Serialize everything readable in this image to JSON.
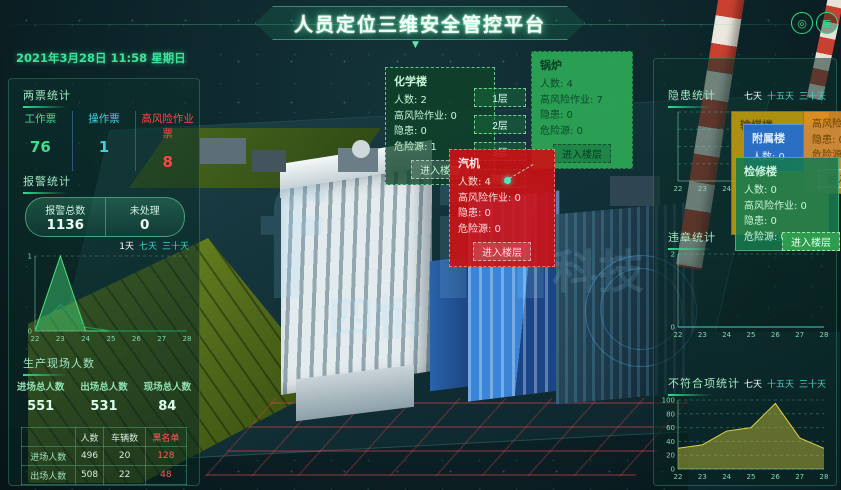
{
  "header": {
    "title": "人员定位三维安全管控平台",
    "datetime": "2021年3月28日 11:58 星期日",
    "icons": {
      "badge": "◎",
      "exit": "≣"
    },
    "caret": "▼"
  },
  "left": {
    "tickets": {
      "title": "两票统计",
      "items": [
        {
          "label": "工作票",
          "value": "76",
          "color": "#3fe08f"
        },
        {
          "label": "操作票",
          "value": "1",
          "color": "#3fd2e0"
        },
        {
          "label": "高风险作业票",
          "value": "8",
          "color": "#ff4545"
        }
      ]
    },
    "alarms": {
      "title": "报警统计",
      "total_label": "报警总数",
      "total_value": "1136",
      "pending_label": "未处理",
      "pending_value": "0",
      "legend": {
        "tabs": [
          "1天",
          "七天",
          "三十天"
        ],
        "active_tab": 0
      }
    },
    "site": {
      "title": "生产现场人数",
      "stats": [
        {
          "label": "进场总人数",
          "value": "551"
        },
        {
          "label": "出场总人数",
          "value": "531"
        },
        {
          "label": "现场总人数",
          "value": "84"
        }
      ],
      "table": {
        "headers": [
          "",
          "人数",
          "车辆数",
          "黑名单"
        ],
        "rows": [
          [
            "进场人数",
            "496",
            "20",
            "128"
          ],
          [
            "出场人数",
            "508",
            "22",
            "48"
          ]
        ]
      }
    }
  },
  "right": {
    "hazards": {
      "title": "隐患统计",
      "tabs": {
        "tabs": [
          "七天",
          "十五天",
          "三十天"
        ],
        "active_tab": 0
      }
    },
    "violations": {
      "title": "违章统计",
      "tabs": {
        "tabs": [
          "七天",
          "十五天",
          "三十天"
        ],
        "active_tab": 0
      }
    },
    "nonconformance": {
      "title": "不符合项统计",
      "tabs": {
        "tabs": [
          "七天",
          "十五天",
          "三十天"
        ],
        "active_tab": 0
      }
    }
  },
  "popups": {
    "chemistry": {
      "title": "化学楼",
      "lines": [
        "人数: 2",
        "高风险作业: 0",
        "隐患: 0",
        "危险源: 1"
      ],
      "button": "进入楼层"
    },
    "floors": [
      "1层",
      "2层",
      "3层",
      "测试"
    ],
    "boiler": {
      "title": "锅炉",
      "lines": [
        "人数: 4",
        "高风险作业: 7",
        "隐患: 0",
        "危险源: 0"
      ],
      "button": "进入楼层"
    },
    "turbine": {
      "title": "汽机",
      "lines": [
        "人数: 4",
        "高风险作业: 0",
        "隐患: 0",
        "危险源: 0"
      ],
      "button": "进入楼层"
    },
    "coal": {
      "title": "输煤楼"
    },
    "annex": {
      "title": "附属楼",
      "lines": [
        "人数: 0"
      ]
    },
    "maintenance": {
      "title": "检修楼",
      "lines": [
        "人数: 0",
        "高风险作业: 0",
        "隐患: 0",
        "危险源: 0"
      ],
      "button": "进入楼层"
    },
    "edge": {
      "lines": [
        "高风险作业: 0",
        "隐患: 0",
        "危险源: 0"
      ],
      "button": "进入楼层"
    }
  },
  "watermark": {
    "en": "f il",
    "cn1": "四相",
    "cn2": "科技"
  },
  "chart_data": [
    {
      "type": "area",
      "title": "报警统计趋势",
      "x": [
        22,
        23,
        24,
        25,
        26,
        27,
        28
      ],
      "ylim": [
        0,
        1
      ],
      "yticks": [
        0,
        1
      ],
      "legend": [
        "1天",
        "七天",
        "三十天"
      ],
      "legend_position": "top-right",
      "series": [
        {
          "name": "1天",
          "values": [
            0,
            1,
            0,
            0,
            0,
            0,
            0
          ],
          "color": "#49e57e"
        },
        {
          "name": "七天",
          "values": [
            0,
            0.35,
            0.05,
            0,
            0,
            0,
            0
          ],
          "color": "#1f9e68",
          "fill": false
        }
      ]
    },
    {
      "type": "line",
      "title": "隐患统计",
      "x": [
        22,
        23,
        24,
        25,
        26,
        27,
        28
      ],
      "ylim": [
        0,
        1
      ],
      "yticks": [
        0.25,
        0.5,
        0.75,
        1
      ],
      "hide_ylabels": true,
      "series": []
    },
    {
      "type": "line",
      "title": "违章统计",
      "x": [
        22,
        23,
        24,
        25,
        26,
        27,
        28
      ],
      "ylim": [
        0,
        2
      ],
      "yticks": [
        0,
        2
      ],
      "series": [
        {
          "name": "违章",
          "values": [
            0,
            0,
            0,
            0,
            0,
            0,
            0
          ],
          "color": "#3fd2c0"
        }
      ]
    },
    {
      "type": "area",
      "title": "不符合项统计",
      "x": [
        22,
        23,
        24,
        25,
        26,
        27,
        28
      ],
      "ylim": [
        0,
        100
      ],
      "yticks": [
        0,
        20,
        40,
        60,
        80,
        100
      ],
      "series": [
        {
          "name": "不符合项",
          "values": [
            30,
            35,
            55,
            60,
            95,
            45,
            30
          ],
          "color": "#ded23e"
        }
      ]
    }
  ]
}
